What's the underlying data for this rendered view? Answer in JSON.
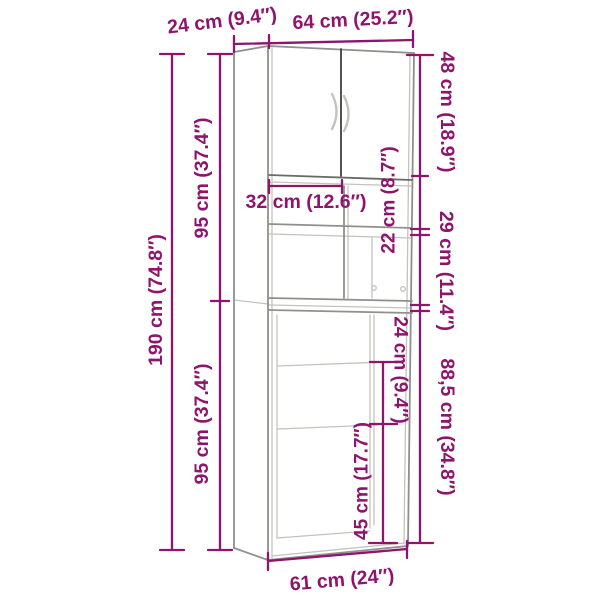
{
  "colors": {
    "dimension": "#8e146c",
    "outline": "#8f8f8b",
    "outline_dark": "#3e3e3e",
    "outline_mid": "#6a6a66",
    "outline_light": "#c2c2be",
    "background": "#ffffff"
  },
  "dims": {
    "top_depth": "24 cm (9.4″)",
    "top_width": "64 cm (25.2″)",
    "total_height": "190 cm (74.8″)",
    "upper_section_height": "95 cm (37.4″)",
    "lower_section_height": "95 cm (37.4″)",
    "door_section_height": "48 cm (18.9″)",
    "niche_width": "32 cm (12.6″)",
    "niche_height": "22 cm (8.7″)",
    "middle_compartment_height": "29 cm (11.4″)",
    "machine_opening_height": "88,5 cm (34.8″)",
    "inner_upper_height": "24 cm (9.4″)",
    "inner_lower_height": "45 cm (17.7″)",
    "bottom_width": "61 cm (24″)"
  }
}
